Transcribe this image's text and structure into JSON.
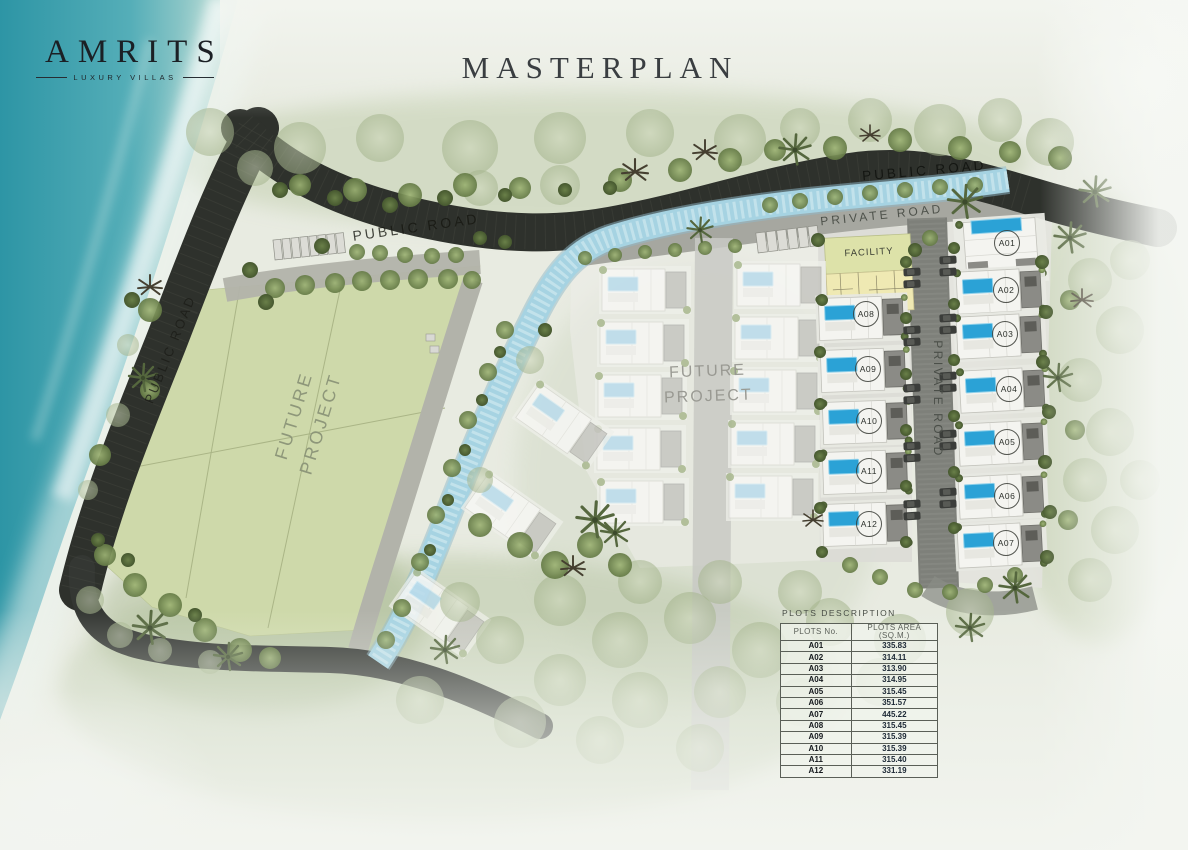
{
  "brand": {
    "name": "AMRITS",
    "tagline": "LUXURY VILLAS"
  },
  "page_title": "MASTERPLAN",
  "map": {
    "road_labels": {
      "public_road_top_left": "PUBLIC ROAD",
      "public_road_left": "PUBLIC ROAD",
      "public_road_top_right": "PUBLIC ROAD",
      "private_road_top": "PRIVATE ROAD",
      "private_road_middle": "PRIVATE ROAD"
    },
    "area_labels": {
      "future_project_left": "FUTURE PROJECT",
      "future_project_center": "FUTURE PROJECT",
      "facility": "FACILITY"
    },
    "features": {
      "ocean": "sea",
      "river": "stream",
      "villa_pools": "swimming-pools"
    }
  },
  "plots_table": {
    "title": "PLOTS DESCRIPTION",
    "columns": [
      "PLOTS No.",
      "PLOTS AREA (SQ.M.)"
    ],
    "rows": [
      {
        "no": "A01",
        "area": "335.83"
      },
      {
        "no": "A02",
        "area": "314.11"
      },
      {
        "no": "A03",
        "area": "313.90"
      },
      {
        "no": "A04",
        "area": "314.95"
      },
      {
        "no": "A05",
        "area": "315.45"
      },
      {
        "no": "A06",
        "area": "351.57"
      },
      {
        "no": "A07",
        "area": "445.22"
      },
      {
        "no": "A08",
        "area": "315.45"
      },
      {
        "no": "A09",
        "area": "315.39"
      },
      {
        "no": "A10",
        "area": "315.39"
      },
      {
        "no": "A11",
        "area": "315.40"
      },
      {
        "no": "A12",
        "area": "331.19"
      }
    ]
  }
}
